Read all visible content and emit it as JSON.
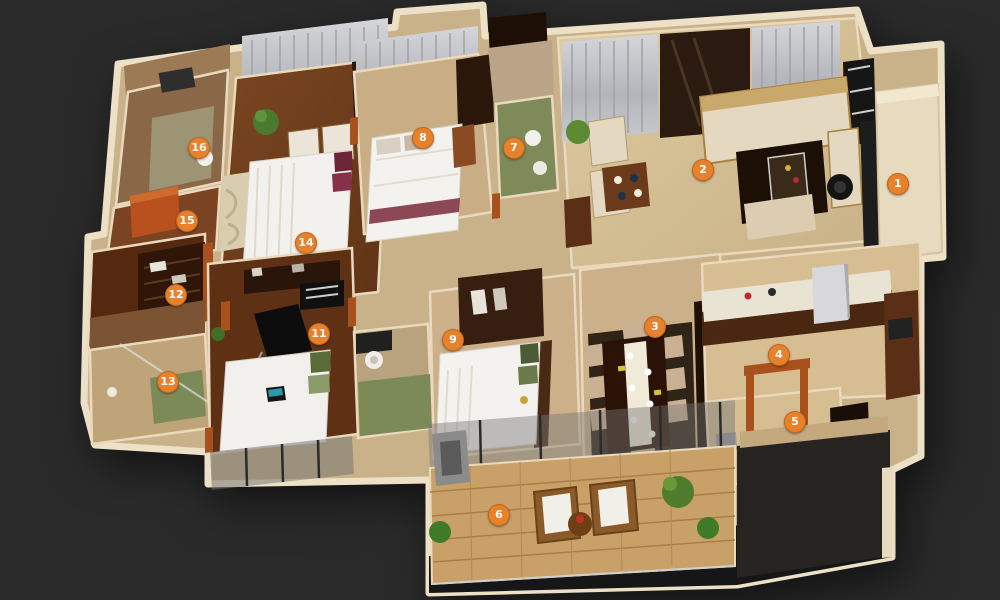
{
  "scene": {
    "background_color": "#2a2a2a",
    "marker_color": "#E8812C",
    "marker_text_color": "#FFFFFF",
    "wall_color": "#ECE0C6",
    "door_frame_color": "#A8511D",
    "wood_floor_color": "#6D3D1E",
    "tile_floor_color": "#CBB089",
    "balcony_parquet_color": "#C9A168",
    "curtain_color": "#B9BabF",
    "glass_color": "#8A8F8C"
  },
  "markers": [
    {
      "label": "1",
      "x": 898,
      "y": 184
    },
    {
      "label": "2",
      "x": 703,
      "y": 170
    },
    {
      "label": "3",
      "x": 655,
      "y": 327
    },
    {
      "label": "4",
      "x": 779,
      "y": 355
    },
    {
      "label": "5",
      "x": 795,
      "y": 422
    },
    {
      "label": "6",
      "x": 499,
      "y": 515
    },
    {
      "label": "7",
      "x": 514,
      "y": 148
    },
    {
      "label": "8",
      "x": 423,
      "y": 138
    },
    {
      "label": "9",
      "x": 453,
      "y": 340
    },
    {
      "label": "11",
      "x": 319,
      "y": 334
    },
    {
      "label": "12",
      "x": 176,
      "y": 295
    },
    {
      "label": "13",
      "x": 168,
      "y": 382
    },
    {
      "label": "14",
      "x": 306,
      "y": 243
    },
    {
      "label": "15",
      "x": 187,
      "y": 221
    },
    {
      "label": "16",
      "x": 199,
      "y": 148
    }
  ]
}
